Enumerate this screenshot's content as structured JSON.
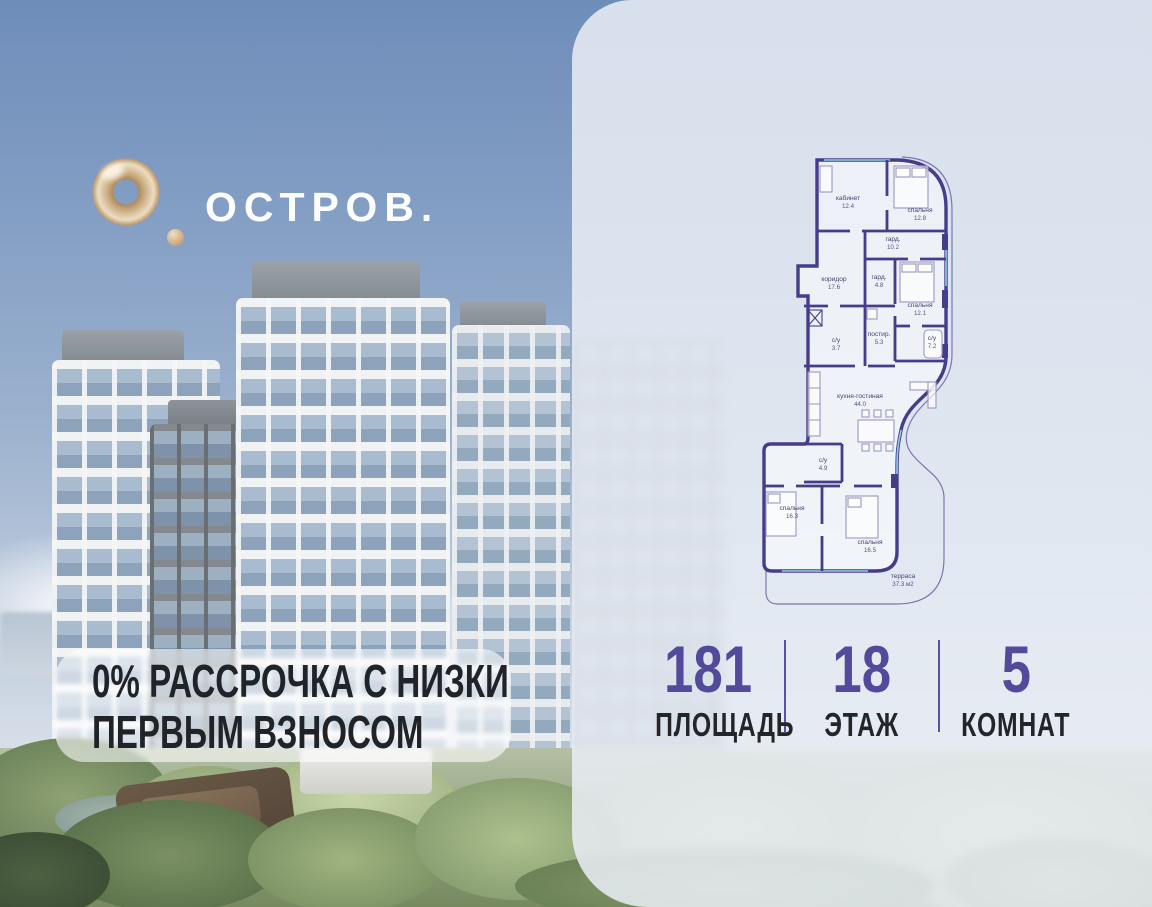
{
  "brand": {
    "wordmark": "ОСТРОВ."
  },
  "promo": {
    "line1": "0% РАССРОЧКА С НИЗКИМ",
    "line2": "ПЕРВЫМ ВЗНОСОМ"
  },
  "floorplan": {
    "rooms": [
      {
        "label": "кабинет",
        "area": "12.4"
      },
      {
        "label": "спальня",
        "area": "12.8"
      },
      {
        "label": "гард.",
        "area": "10.2"
      },
      {
        "label": "коридор",
        "area": "17.6"
      },
      {
        "label": "гард.",
        "area": "4.8"
      },
      {
        "label": "спальня",
        "area": "12.1"
      },
      {
        "label": "постир.",
        "area": "5.3"
      },
      {
        "label": "с/у",
        "area": "3.7"
      },
      {
        "label": "с/у",
        "area": "7.2"
      },
      {
        "label": "кухня-гостиная",
        "area": "44.0"
      },
      {
        "label": "с/у",
        "area": "4.9"
      },
      {
        "label": "спальня",
        "area": "16.3"
      },
      {
        "label": "спальня",
        "area": "16.5"
      },
      {
        "label": "терраса",
        "area": "37.3 м2"
      }
    ]
  },
  "stats": {
    "items": [
      {
        "value": "181",
        "label": "ПЛОЩАДЬ"
      },
      {
        "value": "18",
        "label": "ЭТАЖ"
      },
      {
        "value": "5",
        "label": "КОМНАТ"
      }
    ]
  },
  "colors": {
    "accent": "#544A9C",
    "walls": "#453C8C",
    "gold": "#C9A87C"
  }
}
